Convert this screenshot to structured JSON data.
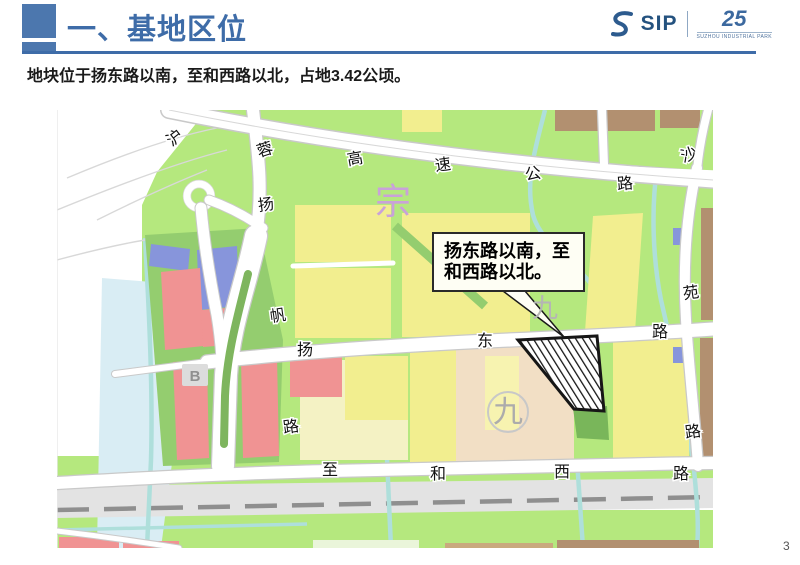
{
  "slide": {
    "title": "一、基地区位",
    "subtitle": "地块位于扬东路以南，至和西路以北，占地3.42公顷。",
    "page_number": "3"
  },
  "logo": {
    "name": "SIP",
    "anniversary": "25",
    "caption": "SUZHOU INDUSTRIAL PARK"
  },
  "map": {
    "callout": {
      "line1": "扬东路以南，至",
      "line2": "和西路以北。"
    },
    "roads": {
      "highway": [
        "沪",
        "蓉",
        "高",
        "速",
        "公",
        "路"
      ],
      "north_road": "沙",
      "yangfan": [
        "扬",
        "帆",
        "路"
      ],
      "yangdong": [
        "扬",
        "东",
        "路"
      ],
      "zhihexi": [
        "至",
        "和",
        "西",
        "路"
      ],
      "yuan": [
        "苑",
        "路"
      ]
    },
    "watermarks": {
      "zong": "宗",
      "jiu_upper": "九",
      "jiu_lower": "九",
      "block_b": "B"
    },
    "colors": {
      "header_blue": "#3E6CA8",
      "accent_square": "#4C77AE",
      "parcel_yellow": "#F2EE8F",
      "parcel_pale_yellow": "#F4F2C4",
      "parcel_red": "#F09393",
      "parcel_blue": "#8795DB",
      "parcel_peach": "#F2DFC5",
      "parcel_brown": "#B29070",
      "green_light": "#B5E87E",
      "green_medium": "#94CD6F",
      "green_dark": "#79B65A",
      "canal": "#AEDFDB",
      "water": "#D9EDF4",
      "railway_band": "#E3E3E3",
      "railway_line": "#8F8F8F",
      "site_outline": "#161616"
    }
  }
}
